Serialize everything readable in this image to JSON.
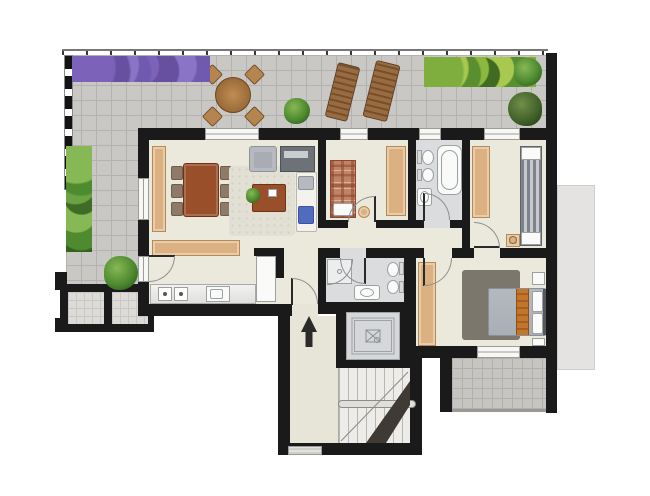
{
  "meta": {
    "type": "architectural-floor-plan",
    "view": "top-down-rendered",
    "canvas_width": 650,
    "canvas_height": 496,
    "text_labels": []
  },
  "annotations": {
    "entrance_arrow_direction": "up"
  },
  "colors": {
    "wall": "#1a1a1a",
    "terrace_tile": "#c9c8c5",
    "terrace_grout": "#b3b2af",
    "tile_light": "#dcdbd8",
    "tile_grout_light": "#c9c8c4",
    "floor_main": "#ebe9dc",
    "floor_bath": "#dadcdd",
    "floor_hall": "#e7e4d8",
    "floor_stairs": "#edece8",
    "tread_line": "#b8b7b2",
    "window_fill": "#f7f7f4",
    "window_line": "#9c9c9c",
    "tan": "#dcb182",
    "tan_dark": "#b68a55",
    "brown": "#9a4f2b",
    "brown_dark": "#6e3317",
    "chair_wood": "#8f7a68",
    "plaid_base": "#c08366",
    "plaid_line": "#8e4630",
    "sofa": "#f3f2ec",
    "blue": "#4f6cbe",
    "gray_furn": "#b6bac0",
    "gray_furn_dark": "#787f88",
    "bed_gray": "#a9afb6",
    "orange": "#c3762b",
    "rug_dark": "#7c776d",
    "rug_light": "#e2e0d4",
    "green": "#4e8a2f",
    "green_light": "#86b855",
    "green_dark": "#2f5c1b",
    "lounger": "#8e6137",
    "lounger_dark": "#5f3c1e",
    "elev_fill": "#d5d7d9",
    "neighbor": "#e4e3e1",
    "arc": "#8f8f8f",
    "leaf": "#2a2a2a",
    "fixture_line": "#9aa0a4",
    "fixture_fill": "#fafaf8",
    "counter_line": "#a9a9a7",
    "underflight": "#3f3b34",
    "handrail": "#e0dfda"
  },
  "rooms": [
    {
      "name": "terrace",
      "features": [
        "lavender-bed",
        "outdoor-dining-table",
        "four-outdoor-chairs",
        "potted-shrub",
        "sun-lounger",
        "sun-lounger",
        "hedge",
        "shrubs",
        "tile-paving",
        "railing"
      ]
    },
    {
      "name": "living-dining-room",
      "features": [
        "tall-sideboard",
        "dining-table",
        "six-chairs",
        "area-rug",
        "coffee-table",
        "houseplant",
        "armchair",
        "tv-bench",
        "sofa-with-blue-cushions",
        "low-sideboard"
      ]
    },
    {
      "name": "kitchen",
      "features": [
        "counter-run",
        "cooktop",
        "sink",
        "tall-cabinet"
      ]
    },
    {
      "name": "bedroom-2",
      "features": [
        "single-bed-plaid",
        "wardrobe",
        "pouf",
        "pillow"
      ]
    },
    {
      "name": "bathroom-1",
      "features": [
        "bathtub",
        "washbasin",
        "toilet",
        "bidet"
      ]
    },
    {
      "name": "dressing-room",
      "features": [
        "wardrobe",
        "slatted-cabinet",
        "stool"
      ]
    },
    {
      "name": "hallway",
      "features": []
    },
    {
      "name": "bathroom-2",
      "features": [
        "corner-shower",
        "washbasin",
        "toilet",
        "bidet"
      ]
    },
    {
      "name": "master-bedroom",
      "features": [
        "double-bed",
        "orange-bed-runner",
        "two-nightstands",
        "wardrobe",
        "dark-area-rug"
      ]
    },
    {
      "name": "master-balcony",
      "features": [
        "tile-paving"
      ]
    },
    {
      "name": "entrance-hall",
      "features": [
        "entry-arrow-up",
        "doormat"
      ]
    },
    {
      "name": "elevator",
      "features": [
        "elevator-car-symbol"
      ]
    },
    {
      "name": "stairwell",
      "features": [
        "stair-treads",
        "handrail",
        "down-flight-shading"
      ]
    },
    {
      "name": "neighbor-terrace",
      "features": [
        "tile-paving"
      ]
    },
    {
      "name": "lower-balcony-cells",
      "features": [
        "tile-paving"
      ]
    }
  ]
}
